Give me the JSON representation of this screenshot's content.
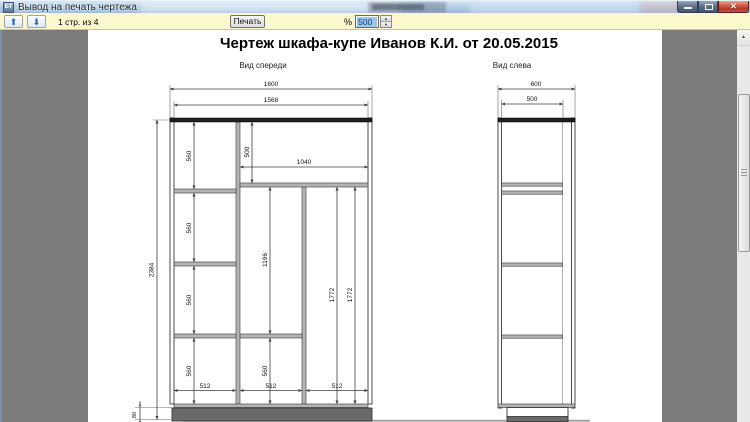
{
  "window": {
    "icon_text": "БТ",
    "title": "Вывод на печать чертежа"
  },
  "icons": {
    "page_up": "⬆",
    "page_down": "⬇",
    "spin_up": "▲",
    "spin_down": "▼",
    "scroll_up": "▲",
    "close": "✕"
  },
  "toolbar": {
    "page_status": "1 стр. из 4",
    "print_label": "Печать",
    "percent_label": "%",
    "zoom_value": "500"
  },
  "document": {
    "title": "Чертеж шкафа-купе Иванов К.И. от 20.05.2015",
    "front_view": {
      "label": "Вид спереди",
      "overall_width": "1600",
      "inner_width": "1568",
      "top_width": "1040",
      "top_height": "500",
      "overall_height": "2384",
      "plinth_height": "80",
      "middle_height": "1196",
      "heights_560": [
        "560",
        "560",
        "560",
        "560",
        "560"
      ],
      "right_heights": [
        "1772",
        "1772"
      ],
      "widths_512": [
        "512",
        "512",
        "512"
      ]
    },
    "side_view": {
      "label": "Вид слева",
      "depth": "600",
      "inner_depth": "500"
    }
  }
}
